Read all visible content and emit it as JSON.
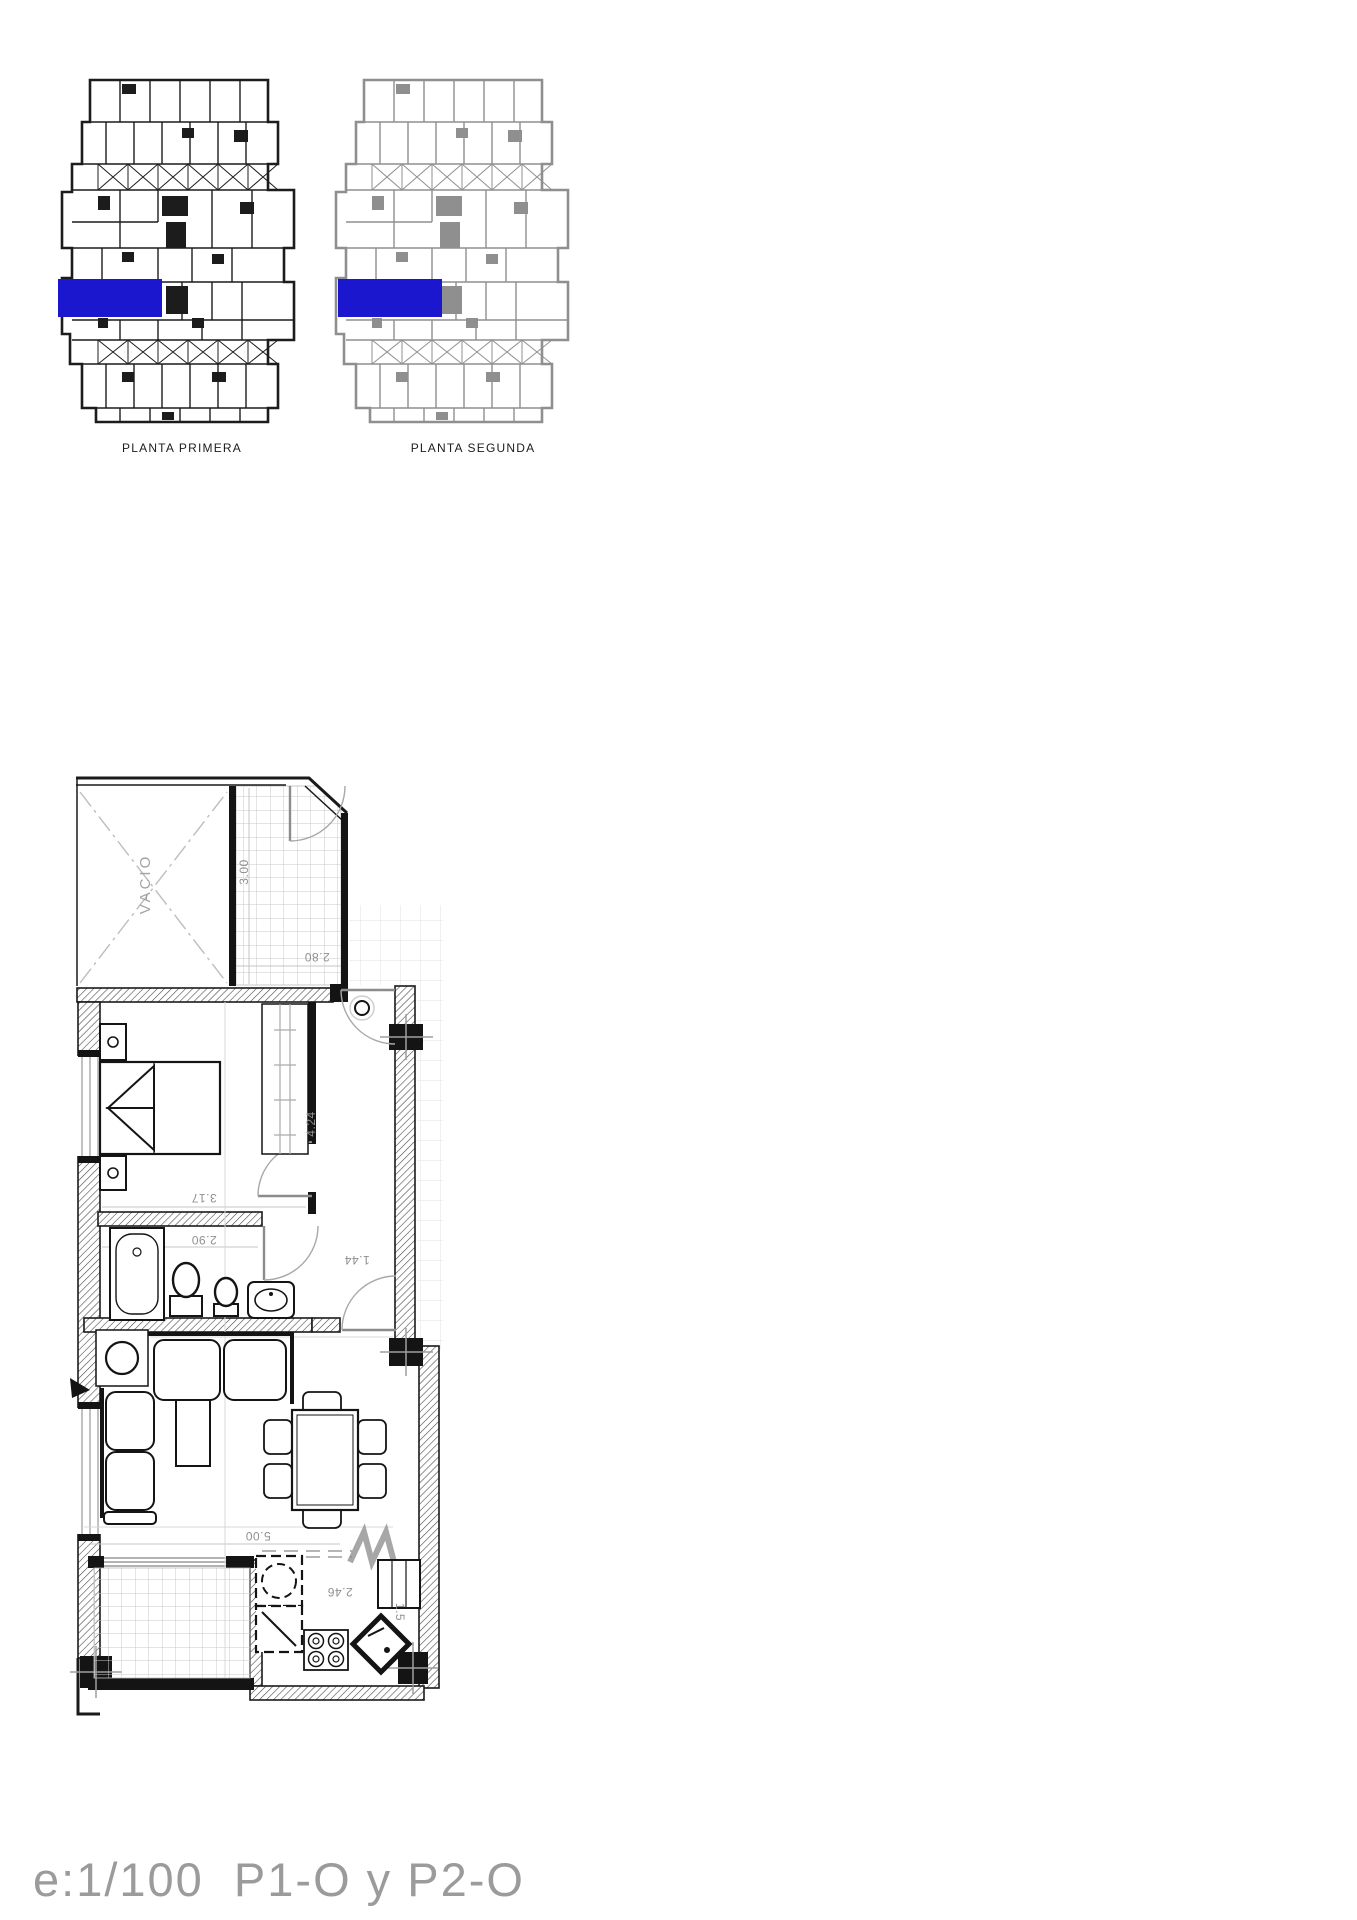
{
  "document": {
    "background_color": "#ffffff",
    "ink_color": "#1c1c1c",
    "secondary_ink_color": "#8f8f8f",
    "accent_blue": "#1a17cf"
  },
  "overview": {
    "plans": [
      {
        "label": "PLANTA PRIMERA"
      },
      {
        "label": "PLANTA SEGUNDA"
      }
    ],
    "highlight_meaning": "selected apartment unit"
  },
  "floor_plan": {
    "void_label": "VACIO",
    "dimensions": {
      "terrace_depth": "3.00",
      "terrace_width": "2.80",
      "bedroom_length": "4.24",
      "bedroom_width": "3.17",
      "bathroom_width": "2.90",
      "hall_width": "1.44",
      "living_width": "5.00",
      "kitchen_width": "2.46",
      "kitchen_depth": "1.5"
    }
  },
  "footer": {
    "scale_label": "e:1/100  P1-O y P2-O"
  }
}
